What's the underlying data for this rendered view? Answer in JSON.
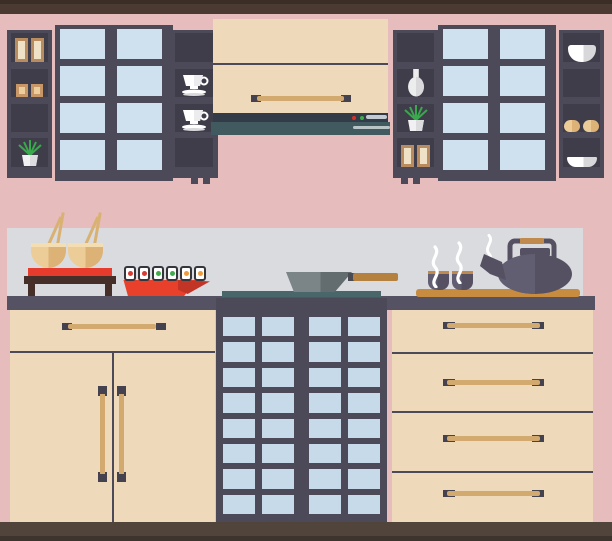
{
  "scene": {
    "subject": "Flat-design Asian kitchen interior illustration",
    "wall": "pink",
    "sections": [
      "upper wall cabinets and open shelves",
      "range hood",
      "countertop with food and tea",
      "lower cabinets"
    ]
  },
  "colors": {
    "wall": "#e6bcbc",
    "frame": "#4a3a31",
    "frame_edge": "#3a2e27",
    "floor": "#51453b",
    "floor_edge": "#3d352d",
    "cab_dark": "#4c4958",
    "cell_dark": "#403d4b",
    "pane_upper": "#cfe1ee",
    "pane_lower": "#c6daea",
    "cream": "#eed9ba",
    "line_dark": "#4c4958",
    "handle_tan": "#d2a96f",
    "handle_cap": "#45424f",
    "hood_navy": "#333a48",
    "hood_teal": "#415a5f",
    "led_red": "#d93025",
    "led_green": "#3fae4a",
    "hood_bar": "#c3cad1",
    "hood_line": "#b9c4c6",
    "backsplash": "#d9dbdf",
    "counter": "#555263",
    "cooktop": "#49666a",
    "stand_wood": "#452f28",
    "mat_red": "#e73b2e",
    "bowl_light": "#eccc97",
    "bowl_dark": "#dcb277",
    "bowl_rim": "#f3ddb1",
    "chopstick": "#d9b273",
    "sushi_border": "#35353c",
    "sushi_red": "#d93a31",
    "sushi_green": "#3fae4a",
    "sushi_orange": "#f09b3a",
    "plate_red": "#e8402b",
    "plate_red_dark": "#c23526",
    "wok_light": "#7b8487",
    "wok_dark": "#636c6f",
    "wok_joint": "#4b4b54",
    "wok_handle": "#b5813f",
    "board": "#c88c41",
    "pot_dark": "#555163",
    "pot_light": "#625e71",
    "grip": "#c08a4e",
    "steam": "#ffffff",
    "white": "#ffffff",
    "pot_shade": "#d8d8db",
    "leaf": "#3aa84d",
    "box_tan": "#b98c60",
    "box_cream": "#efe2c6",
    "box_small": "#c89767",
    "box_small_light": "#ecce9d"
  },
  "glass_grids": {
    "upper": {
      "cols": 2,
      "rows": 4
    },
    "lower": {
      "cols": 2,
      "rows": 8
    }
  },
  "shelf_items": {
    "upper_left_unit": {
      "left_column": [
        "two storage boxes",
        "two small boxes",
        "empty",
        "potted plant"
      ],
      "right_column": [
        "empty",
        "teacup with saucer",
        "teacup with saucer",
        "empty"
      ]
    },
    "upper_right_unit": {
      "left_column": [
        "empty",
        "vase",
        "potted plant",
        "two storage boxes"
      ],
      "right_column": [
        "bowl",
        "empty",
        "two brown bowls",
        "shallow dish"
      ]
    }
  },
  "range_hood": {
    "leds": [
      "red",
      "green"
    ],
    "controls": "slider bar"
  },
  "counter_items": {
    "rice_bowls": {
      "count": 2,
      "accessory": "chopsticks",
      "stand": "red mat on dark wooden stool"
    },
    "sushi": {
      "pieces": [
        "red",
        "red",
        "green",
        "green",
        "orange",
        "orange"
      ],
      "plate": "red sushi boat"
    },
    "wok": {
      "body": "steel",
      "handle": "wooden",
      "on": "cooktop strip"
    },
    "tea": {
      "cups": 2,
      "teapot": 1,
      "board": "wooden serving board",
      "steam_wisps": 3
    }
  },
  "lower_cabinets": {
    "left": {
      "drawer_handles": 1,
      "doors": 2,
      "door_handles": "vertical"
    },
    "center": {
      "type": "shoji glass unit",
      "doors": 2
    },
    "right": {
      "drawers": 4
    }
  }
}
